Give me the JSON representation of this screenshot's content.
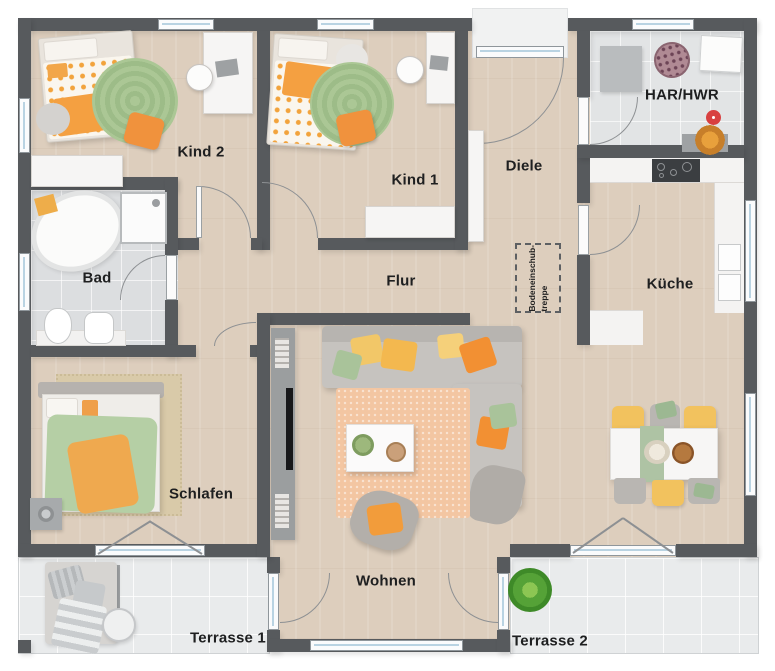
{
  "title": "Bungalow Grundriss",
  "rooms": [
    {
      "id": "kind2",
      "label": "Kind 2"
    },
    {
      "id": "kind1",
      "label": "Kind 1"
    },
    {
      "id": "diele",
      "label": "Diele"
    },
    {
      "id": "har_hwr",
      "label": "HAR/HWR"
    },
    {
      "id": "kueche",
      "label": "Küche"
    },
    {
      "id": "bad",
      "label": "Bad"
    },
    {
      "id": "flur",
      "label": "Flur"
    },
    {
      "id": "schlafen",
      "label": "Schlafen"
    },
    {
      "id": "wohnen",
      "label": "Wohnen"
    },
    {
      "id": "terrasse1",
      "label": "Terrasse 1"
    },
    {
      "id": "terrasse2",
      "label": "Terrasse 2"
    }
  ],
  "annotations": {
    "elt": "ELT",
    "attic_stairs_line1": "Bodeneinschub-",
    "attic_stairs_line2": "treppe"
  },
  "colors": {
    "wall": "#575a5d",
    "wood_floor": "#ddcebd",
    "tile_floor": "#dcdee0",
    "terrace_floor": "#e9ebec",
    "accent_orange": "#f29a3e",
    "accent_green": "#a9c795",
    "accent_yellow": "#f2c25e",
    "window_glass": "#b9d3e2"
  }
}
